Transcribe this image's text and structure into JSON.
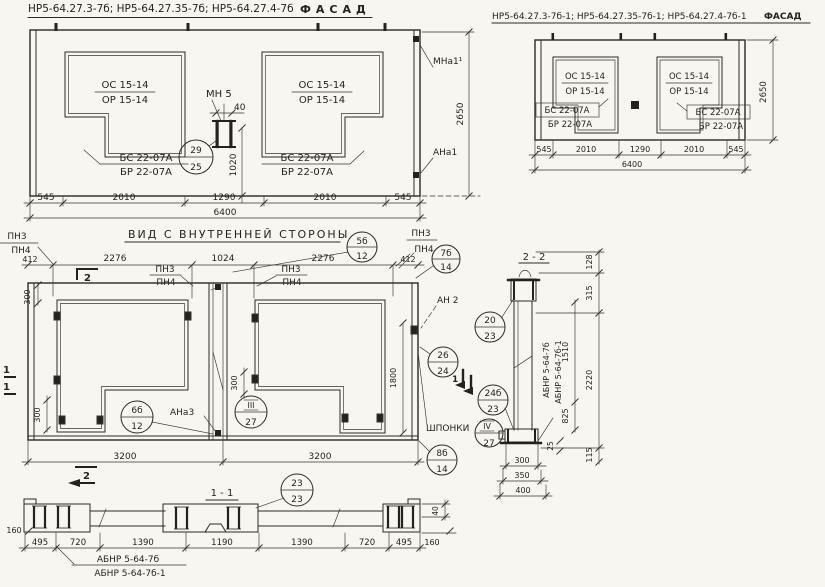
{
  "colors": {
    "paper": "#f8f6f0",
    "ink": "#2b2a24"
  },
  "titles": {
    "facade_left": "НР5-64.27.3-7б; НР5-64.27.35-7б; НР5-64.27.4-7б",
    "facade_left_view": "ФАСАД",
    "facade_right": "НР5-64.27.3-7б-1; НР5-64.27.35-7б-1; НР5-64.27.4-7б-1",
    "facade_right_view": "ФАСАД",
    "inner_view": "ВИД С ВНУТРЕННЕЙ СТОРОНЫ",
    "section_1": "1 - 1",
    "section_2": "2 - 2"
  },
  "marks": {
    "os": "ОС 15-14",
    "orr": "ОР 15-14",
    "bs": "БС 22-07А",
    "br": "БР 22-07А",
    "mn5": "МН 5",
    "mna1": "МНа1¹",
    "ana1": "АНа1",
    "mna3": "МНа3",
    "ana3": "АНа3",
    "an2": "АН 2",
    "pn3": "ПН3",
    "pn4": "ПН4",
    "shponki": "ШПОНКИ",
    "abnr": "АБНР 5-64-7б",
    "abnr1": "АБНР 5-64-7б-1"
  },
  "dims": {
    "d40": "40",
    "d545": "545",
    "d2010": "2010",
    "d1290": "1290",
    "d6400": "6400",
    "d1020": "1020",
    "d2650": "2650",
    "d412": "412",
    "d2276": "2276",
    "d1024": "1024",
    "d300": "300",
    "d1800": "1800",
    "d3200": "3200",
    "d128": "128",
    "d315": "315",
    "d2220": "2220",
    "d1510": "1510",
    "d825": "825",
    "d25": "25",
    "d115": "115",
    "d350": "350",
    "d400": "400",
    "d160": "160",
    "d495": "495",
    "d720": "720",
    "d1390": "1390",
    "d1190": "1190"
  },
  "callouts": {
    "c29": {
      "a": "29",
      "b": "25"
    },
    "c5b": {
      "a": "5б",
      "b": "12"
    },
    "c7b": {
      "a": "7б",
      "b": "14"
    },
    "c20": {
      "a": "20",
      "b": "23"
    },
    "c26": {
      "a": "26",
      "b": "24"
    },
    "c24b": {
      "a": "24б",
      "b": "23"
    },
    "c6b": {
      "a": "6б",
      "b": "12"
    },
    "c3": {
      "a": "III",
      "b": "27"
    },
    "c4": {
      "a": "IV",
      "b": "27"
    },
    "c8b": {
      "a": "8б",
      "b": "14"
    },
    "c23": {
      "a": "23",
      "b": "23"
    }
  },
  "markers": {
    "m1": "1",
    "m2": "2"
  }
}
